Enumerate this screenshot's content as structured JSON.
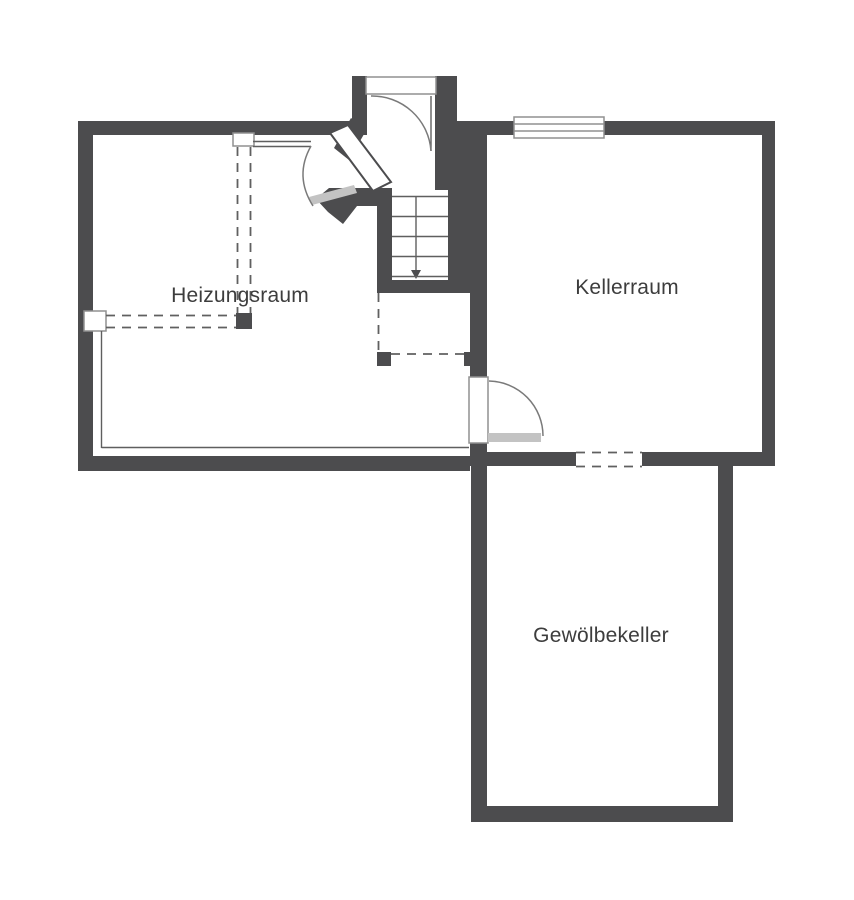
{
  "plan": {
    "title": "Kellergeschoss Grundriss",
    "rooms": [
      {
        "id": "heizungsraum",
        "label": "Heizungsraum"
      },
      {
        "id": "kellerraum",
        "label": "Kellerraum"
      },
      {
        "id": "gewoelbekeller",
        "label": "Gewölbekeller"
      }
    ],
    "features": [
      "entrance-vestibule-top",
      "staircase-with-direction-arrow",
      "swing-door-to-heizungsraum",
      "swing-door-to-kellerraum",
      "window-top-wall",
      "dashed-opening-to-gewoelbekeller",
      "dashed-construction-lines"
    ]
  },
  "colors": {
    "wall": "#4c4c4e",
    "line": "#5f5f5f",
    "dashed": "#606060",
    "frame": "#909090",
    "swing": "#7a7a7a",
    "door_leaf": "#c3c3c3",
    "text": "#3d3d3d",
    "background": "#ffffff"
  }
}
